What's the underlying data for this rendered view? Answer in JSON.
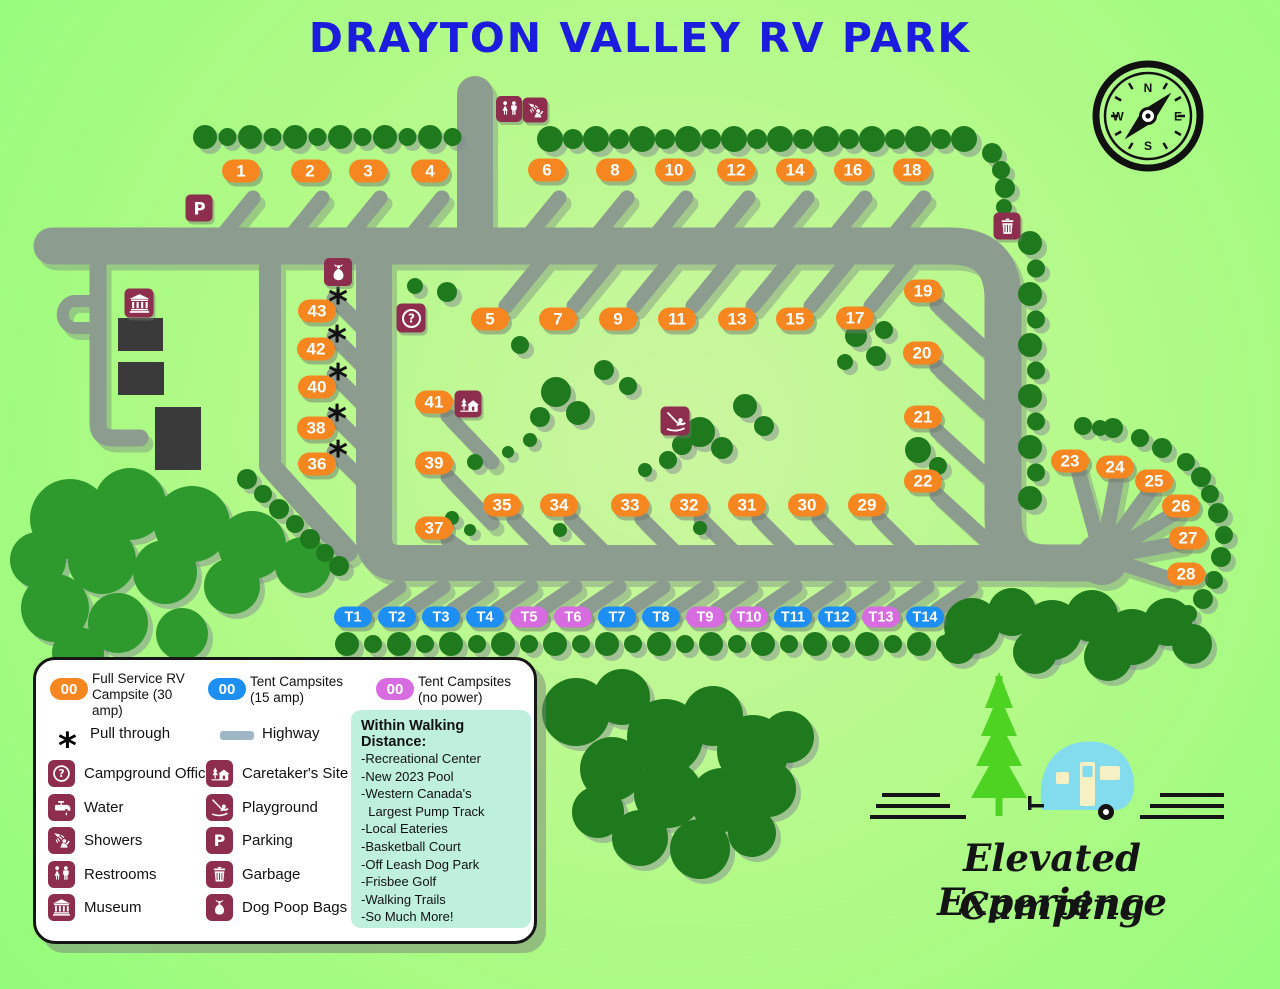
{
  "title": "DRAYTON VALLEY RV PARK",
  "compass": {
    "n": "N",
    "e": "E",
    "s": "S",
    "w": "W"
  },
  "colors": {
    "rv_site": "#f6861f",
    "tent_15amp": "#1e8ff2",
    "tent_no_power": "#d66ce0",
    "icon_box": "#8e2e4f",
    "road": "#8c9c8e",
    "title_blue": "#1c1cde",
    "walk_box": "#bff0de",
    "logo_tree_green": "#4fd322",
    "logo_camper_blue": "#82dcee"
  },
  "map": {
    "rv_sites": [
      {
        "n": "1",
        "x": 241,
        "y": 171
      },
      {
        "n": "2",
        "x": 310,
        "y": 171
      },
      {
        "n": "3",
        "x": 368,
        "y": 171
      },
      {
        "n": "4",
        "x": 430,
        "y": 171
      },
      {
        "n": "6",
        "x": 547,
        "y": 170
      },
      {
        "n": "8",
        "x": 615,
        "y": 170
      },
      {
        "n": "10",
        "x": 674,
        "y": 170
      },
      {
        "n": "12",
        "x": 736,
        "y": 170
      },
      {
        "n": "14",
        "x": 795,
        "y": 170
      },
      {
        "n": "16",
        "x": 853,
        "y": 170
      },
      {
        "n": "18",
        "x": 912,
        "y": 170
      },
      {
        "n": "5",
        "x": 490,
        "y": 319
      },
      {
        "n": "7",
        "x": 558,
        "y": 319
      },
      {
        "n": "9",
        "x": 618,
        "y": 319
      },
      {
        "n": "11",
        "x": 677,
        "y": 319
      },
      {
        "n": "13",
        "x": 737,
        "y": 319
      },
      {
        "n": "15",
        "x": 795,
        "y": 319
      },
      {
        "n": "17",
        "x": 855,
        "y": 318
      },
      {
        "n": "19",
        "x": 923,
        "y": 291
      },
      {
        "n": "20",
        "x": 922,
        "y": 353
      },
      {
        "n": "21",
        "x": 923,
        "y": 417
      },
      {
        "n": "22",
        "x": 923,
        "y": 481
      },
      {
        "n": "23",
        "x": 1070,
        "y": 461
      },
      {
        "n": "24",
        "x": 1115,
        "y": 467
      },
      {
        "n": "25",
        "x": 1154,
        "y": 481
      },
      {
        "n": "26",
        "x": 1181,
        "y": 506
      },
      {
        "n": "27",
        "x": 1188,
        "y": 538
      },
      {
        "n": "28",
        "x": 1186,
        "y": 574
      },
      {
        "n": "29",
        "x": 867,
        "y": 505
      },
      {
        "n": "30",
        "x": 807,
        "y": 505
      },
      {
        "n": "31",
        "x": 747,
        "y": 505
      },
      {
        "n": "32",
        "x": 689,
        "y": 505
      },
      {
        "n": "33",
        "x": 630,
        "y": 505
      },
      {
        "n": "34",
        "x": 559,
        "y": 505
      },
      {
        "n": "35",
        "x": 502,
        "y": 505
      },
      {
        "n": "36",
        "x": 317,
        "y": 464,
        "pull": true
      },
      {
        "n": "37",
        "x": 434,
        "y": 528
      },
      {
        "n": "38",
        "x": 316,
        "y": 428,
        "pull": true
      },
      {
        "n": "39",
        "x": 434,
        "y": 463
      },
      {
        "n": "40",
        "x": 317,
        "y": 387,
        "pull": true
      },
      {
        "n": "41",
        "x": 434,
        "y": 402
      },
      {
        "n": "42",
        "x": 316,
        "y": 349,
        "pull": true
      },
      {
        "n": "43",
        "x": 317,
        "y": 311,
        "pull": true
      }
    ],
    "tent_sites": [
      {
        "n": "T1",
        "x": 353,
        "y": 617,
        "power": true
      },
      {
        "n": "T2",
        "x": 397,
        "y": 617,
        "power": true
      },
      {
        "n": "T3",
        "x": 441,
        "y": 617,
        "power": true
      },
      {
        "n": "T4",
        "x": 485,
        "y": 617,
        "power": true
      },
      {
        "n": "T5",
        "x": 529,
        "y": 617,
        "power": false
      },
      {
        "n": "T6",
        "x": 573,
        "y": 617,
        "power": false
      },
      {
        "n": "T7",
        "x": 617,
        "y": 617,
        "power": true
      },
      {
        "n": "T8",
        "x": 661,
        "y": 617,
        "power": true
      },
      {
        "n": "T9",
        "x": 705,
        "y": 617,
        "power": false
      },
      {
        "n": "T10",
        "x": 749,
        "y": 617,
        "power": false
      },
      {
        "n": "T11",
        "x": 793,
        "y": 617,
        "power": true
      },
      {
        "n": "T12",
        "x": 837,
        "y": 617,
        "power": true
      },
      {
        "n": "T13",
        "x": 881,
        "y": 617,
        "power": false
      },
      {
        "n": "T14",
        "x": 925,
        "y": 617,
        "power": true
      }
    ],
    "icons": [
      {
        "name": "restrooms",
        "x": 509,
        "y": 109,
        "s": 26
      },
      {
        "name": "showers",
        "x": 535,
        "y": 110,
        "s": 25
      },
      {
        "name": "parking",
        "x": 199,
        "y": 208,
        "s": 27
      },
      {
        "name": "dog-poop-bags",
        "x": 338,
        "y": 272,
        "s": 28
      },
      {
        "name": "museum",
        "x": 139,
        "y": 303,
        "s": 29
      },
      {
        "name": "campground-office",
        "x": 411,
        "y": 318,
        "s": 29
      },
      {
        "name": "caretakers-site",
        "x": 468,
        "y": 404,
        "s": 27
      },
      {
        "name": "playground",
        "x": 675,
        "y": 421,
        "s": 29
      },
      {
        "name": "garbage",
        "x": 1007,
        "y": 226,
        "s": 27
      }
    ]
  },
  "legend": {
    "pills": [
      {
        "code": "00",
        "label": "Full Service RV Campsite (30 amp)",
        "color": "#f6861f"
      },
      {
        "code": "00",
        "label": "Tent Campsites (15 amp)",
        "color": "#1e8ff2"
      },
      {
        "code": "00",
        "label": "Tent Campsites (no power)",
        "color": "#d66ce0"
      }
    ],
    "pull_through": {
      "symbol": "*",
      "label": "Pull through"
    },
    "highway_label": "Highway",
    "items": [
      {
        "icon": "campground-office",
        "label": "Campground Office"
      },
      {
        "icon": "caretakers-site",
        "label": "Caretaker's Site"
      },
      {
        "icon": "water",
        "label": "Water"
      },
      {
        "icon": "playground",
        "label": "Playground"
      },
      {
        "icon": "showers",
        "label": "Showers"
      },
      {
        "icon": "parking",
        "label": "Parking"
      },
      {
        "icon": "restrooms",
        "label": "Restrooms"
      },
      {
        "icon": "garbage",
        "label": "Garbage"
      },
      {
        "icon": "museum",
        "label": "Museum"
      },
      {
        "icon": "dog-poop-bags",
        "label": "Dog Poop Bags"
      }
    ]
  },
  "walking": {
    "title": "Within Walking Distance:",
    "items": [
      "-Recreational Center",
      "-New 2023 Pool",
      "-Western Canada's",
      "  Largest Pump Track",
      "-Local Eateries",
      "-Basketball Court",
      "-Off Leash Dog Park",
      "-Frisbee Golf",
      "-Walking Trails",
      "-So Much More!"
    ]
  },
  "logo": {
    "line1": "Elevated Experience",
    "line2": "Camping"
  }
}
